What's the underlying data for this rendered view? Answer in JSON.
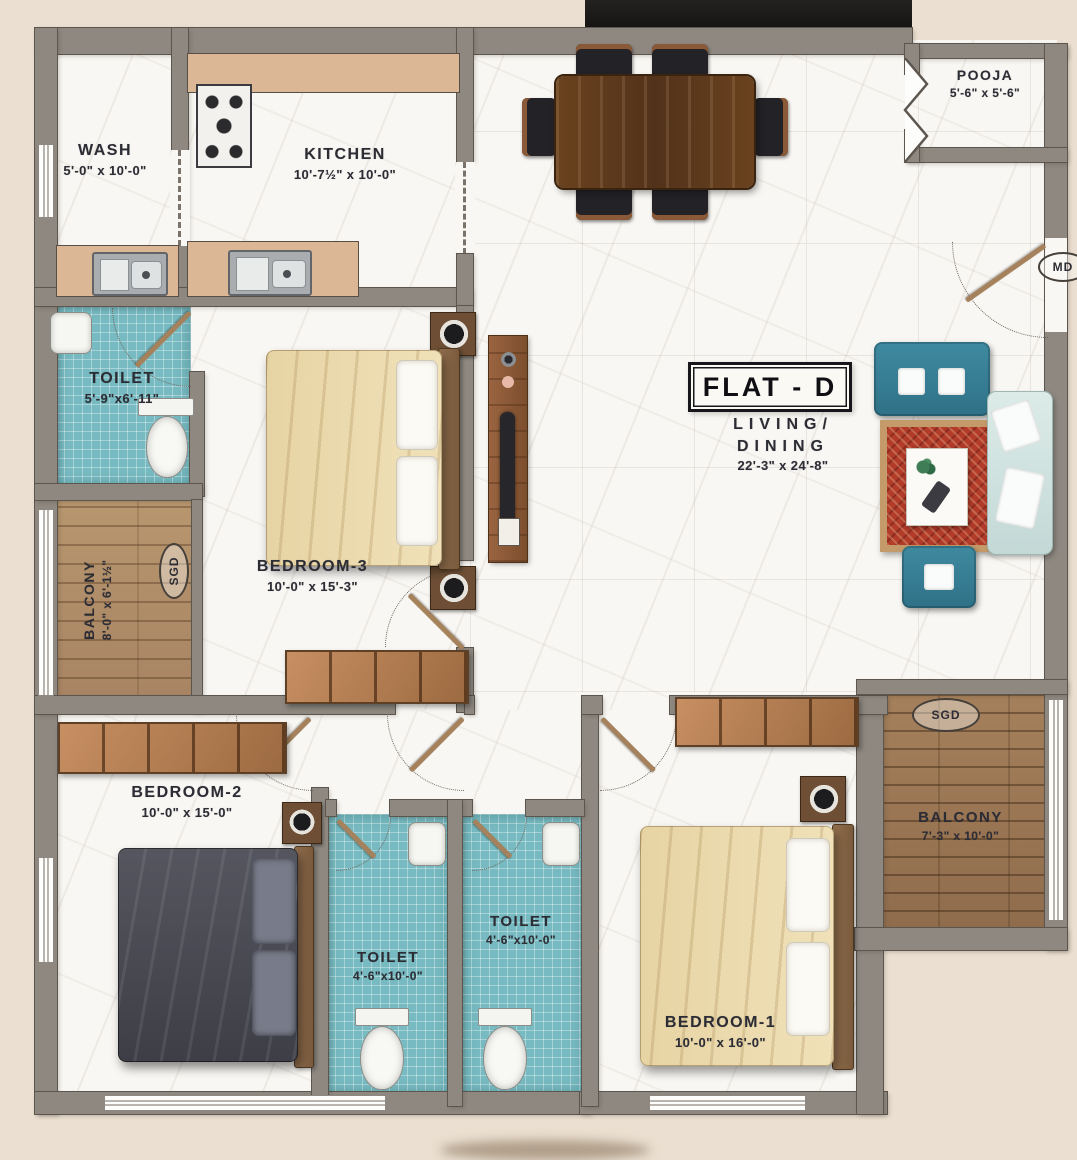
{
  "flat_label": "FLAT - D",
  "rooms": {
    "wash": {
      "name": "WASH",
      "dims": "5'-0\" x 10'-0\""
    },
    "kitchen": {
      "name": "KITCHEN",
      "dims": "10'-7½\" x 10'-0\""
    },
    "pooja": {
      "name": "POOJA",
      "dims": "5'-6\" x 5'-6\""
    },
    "toilet_top": {
      "name": "TOILET",
      "dims": "5'-9\"x6'-11\""
    },
    "balcony_left": {
      "name": "BALCONY",
      "dims": "8'-0\" x 6'-1½\""
    },
    "bedroom3": {
      "name": "BEDROOM-3",
      "dims": "10'-0\" x 15'-3\""
    },
    "living": {
      "line1": "LIVING/",
      "line2": "DINING",
      "dims": "22'-3\" x 24'-8\""
    },
    "bedroom2": {
      "name": "BEDROOM-2",
      "dims": "10'-0\" x 15'-0\""
    },
    "toilet_bed2": {
      "name": "TOILET",
      "dims": "4'-6\"x10'-0\""
    },
    "toilet_bed1": {
      "name": "TOILET",
      "dims": "4'-6\"x10'-0\""
    },
    "bedroom1": {
      "name": "BEDROOM-1",
      "dims": "10'-0\" x 16'-0\""
    },
    "balcony_right": {
      "name": "BALCONY",
      "dims": "7'-3\" x 10'-0\""
    }
  },
  "markers": {
    "sliding_door_left": "SGD",
    "sliding_door_right": "SGD",
    "main_door": "MD"
  },
  "colors": {
    "background": "#eadfd0",
    "wall": "#8e8881",
    "floor_marble": "#f9f7f3",
    "toilet_tile": "#77bac1",
    "balcony_wood": "#b8976f",
    "sofa_teal": "#3f8aa0",
    "rug_red": "#b23b2a",
    "bed_cream": "#ecdbae",
    "bed_dark": "#4b4c55",
    "banner_black": "#171512"
  }
}
